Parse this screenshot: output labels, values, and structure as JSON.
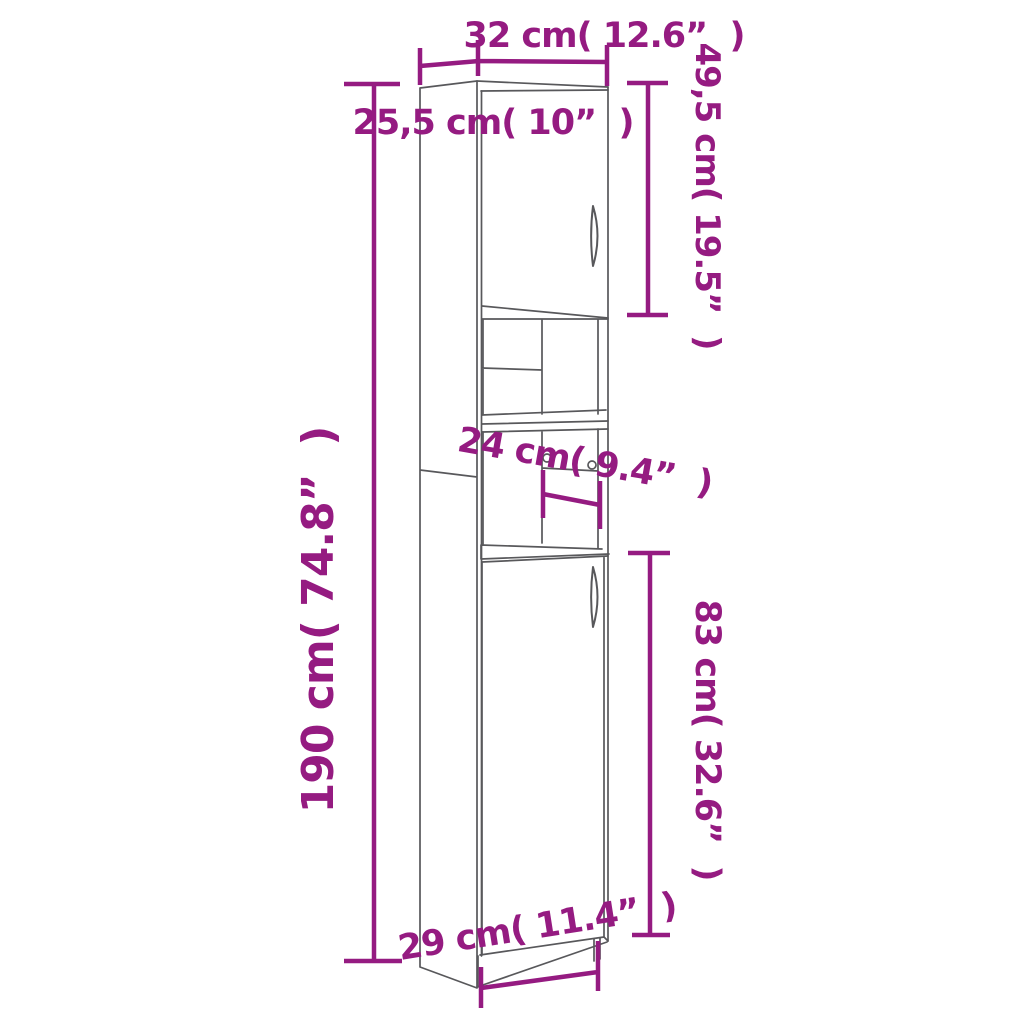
{
  "diagram": {
    "title": "cabinet-dimension-diagram",
    "subject": "tall narrow cabinet with upper door, two open shelves and lower door",
    "colors": {
      "dimension": "#951B81",
      "outline": "#58585B",
      "background": "#FFFFFF"
    },
    "dimensions": {
      "top_width": {
        "label": "32 cm( 12.6”  )",
        "value_cm": 32,
        "value_in": 12.6
      },
      "top_depth": {
        "label": "25,5 cm( 10”  )",
        "value_cm": 25.5,
        "value_in": 10
      },
      "upper_door_height": {
        "label": "49,5 cm( 19.5”  )",
        "value_cm": 49.5,
        "value_in": 19.5
      },
      "total_height": {
        "label": "190 cm( 74.8”  )",
        "value_cm": 190,
        "value_in": 74.8
      },
      "shelf_depth": {
        "label": "24 cm( 9.4”  )",
        "value_cm": 24,
        "value_in": 9.4
      },
      "lower_door_height": {
        "label": "83 cm( 32.6”  )",
        "value_cm": 83,
        "value_in": 32.6
      },
      "base_width": {
        "label": "29 cm( 11.4”  )",
        "value_cm": 29,
        "value_in": 11.4
      }
    }
  }
}
